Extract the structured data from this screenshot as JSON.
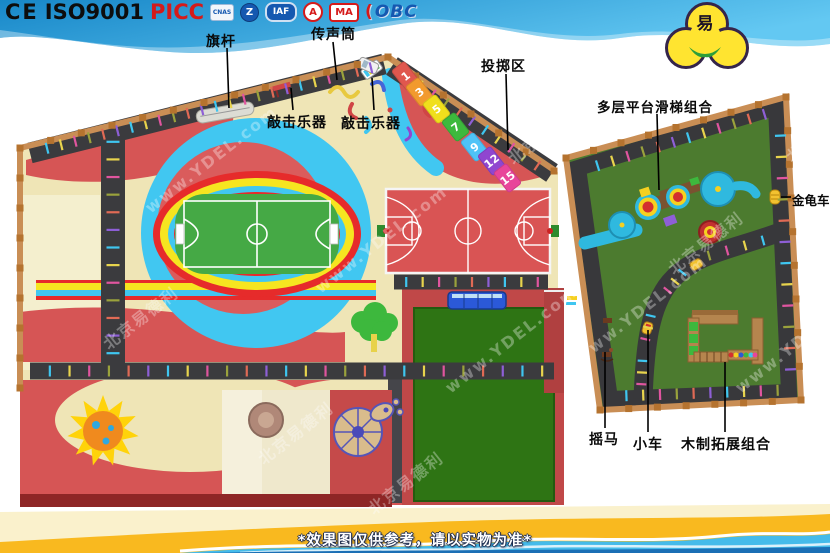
{
  "header": {
    "certifications": [
      "CE",
      "ISO9001",
      "PICC"
    ],
    "badges": [
      "CNAS",
      "Z",
      "IAF",
      "A",
      "MA",
      "OBC"
    ],
    "logo": {
      "symbol": "易"
    }
  },
  "annotations": [
    {
      "id": "flagpole",
      "text": "旗杆"
    },
    {
      "id": "speaking-tube",
      "text": "传声筒"
    },
    {
      "id": "percussion-1",
      "text": "敲击乐器"
    },
    {
      "id": "percussion-2",
      "text": "敲击乐器"
    },
    {
      "id": "throwing-area",
      "text": "投掷区"
    },
    {
      "id": "slide-combo",
      "text": "多层平台滑梯组合"
    },
    {
      "id": "beetle-car",
      "text": "金龟车"
    },
    {
      "id": "rocking-horse",
      "text": "摇马"
    },
    {
      "id": "small-car",
      "text": "小车"
    },
    {
      "id": "wooden-combo",
      "text": "木制拓展组合"
    }
  ],
  "throwing_panels": [
    {
      "label": "1",
      "color": "#e0574e"
    },
    {
      "label": "3",
      "color": "#f29a2e"
    },
    {
      "label": "5",
      "color": "#f0df1c"
    },
    {
      "label": "7",
      "color": "#3db93d"
    },
    {
      "label": "9",
      "color": "#4fc3f7"
    },
    {
      "label": "12",
      "color": "#9046d0"
    },
    {
      "label": "15",
      "color": "#e8459a"
    }
  ],
  "watermark": {
    "cn": "北京易德利",
    "url": "www.YDEL.com"
  },
  "footer": {
    "disclaimer": "*效果图仅供参考，请以实物为准*"
  },
  "colors": {
    "sky_blue": "#2fa8df",
    "ground_beige": "#efe5b6",
    "ground_red": "#d65555",
    "track_red": "#e62b2b",
    "track_yellow": "#f6e520",
    "track_cyan": "#41c7f1",
    "pitch_green": "#45a945",
    "field_green": "#2e7414",
    "turf_green": "#4c7b2f",
    "road_dark": "#3b3b3e",
    "wood": "#c4874f",
    "banner_yellow": "#f9b91f",
    "banner_blue": "#45bbea",
    "tick_palette": [
      "#3fc6f0",
      "#e8d44d",
      "#e0559f",
      "#9aa23c",
      "#e06a55",
      "#8e5fd6"
    ]
  }
}
